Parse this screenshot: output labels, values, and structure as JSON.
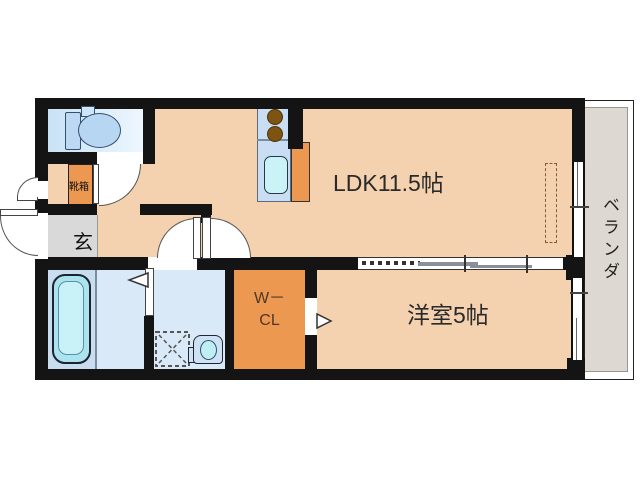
{
  "title": "apartment-floor-plan",
  "rooms": {
    "ldk": {
      "label": "LDK11.5帖"
    },
    "western_room": {
      "label": "洋室5帖"
    },
    "veranda": {
      "label": "ベランダ"
    },
    "genkan": {
      "label": "玄"
    },
    "shoe_box": {
      "label": "靴箱"
    },
    "walk_in_closet": {
      "label_line1": "W－",
      "label_line2": "CL"
    }
  },
  "fixtures": {
    "toilet": "toilet-icon",
    "kitchen_stove": "stove-burners-icon",
    "kitchen_sink": "kitchen-sink-icon",
    "bathtub": "bathtub-icon",
    "washing_machine": "washing-machine-space-icon",
    "washbasin": "washbasin-icon",
    "sliding_partition": "sliding-door-symbol",
    "swing_doors": "door-swing-arc-symbol",
    "folding_door_markers": "folding-door-triangle-symbol",
    "windows": "sliding-window-symbol",
    "refrigerator_space": "dashed-space-symbol"
  },
  "colors": {
    "floor": "#f4d2b0",
    "wall": "#141414",
    "closet_orange": "#ec9851",
    "toilet_blue": "#c8e2f6",
    "bath_blue": "#c9ddf0",
    "washroom_blue": "#d9e9f8",
    "counter_blue": "#c9def2",
    "sink_cyan": "#c9f3f7",
    "genkan_gray": "#d9d9d9",
    "veranda_gray": "#ddd8d1"
  }
}
